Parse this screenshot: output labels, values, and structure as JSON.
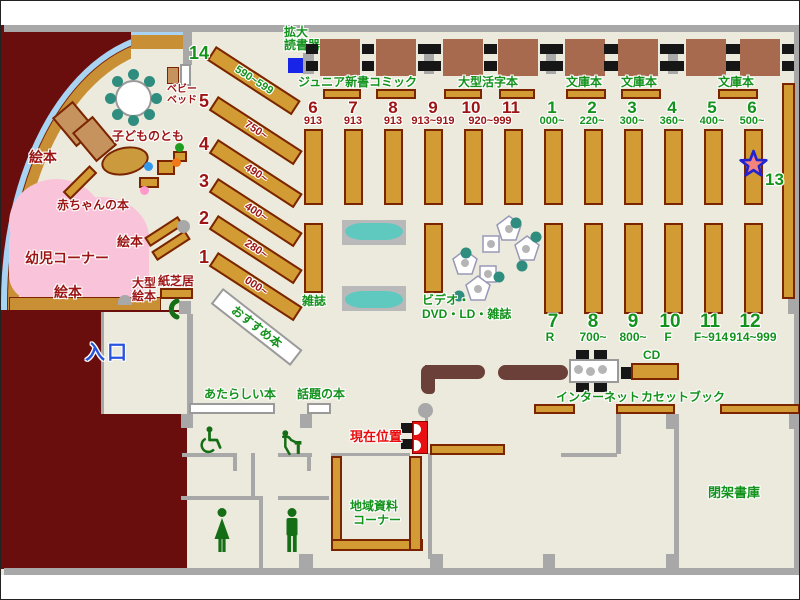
{
  "palette": {
    "floor": "#eceadc",
    "wall": "#a8a8a8",
    "shelf": "#d29b33",
    "entrance_block": "#6a0d0d",
    "counter": "#6a4038",
    "green": "#13921c",
    "dark_red": "#9c1414",
    "red": "#e80c0c",
    "blue": "#2953de",
    "pink": "#f9c3d9",
    "teal": "#2e8d7e",
    "sofa": "#5fc9bf",
    "glass": "#a8d3f2"
  },
  "entrance": {
    "label": "入口"
  },
  "kids_area": {
    "picture_books": "絵本",
    "infant_corner": "幼児コーナー",
    "baby_books": "赤ちゃんの本",
    "kodomono_tomo": "子どものとも",
    "baby_bed_line1": "ベビー",
    "baby_bed_line2": "ベッド",
    "large_picture_books_line1": "大型",
    "large_picture_books_line2": "絵本",
    "kamishibai": "紙芝居"
  },
  "west_shelves": [
    {
      "num": "14",
      "range": "590~599"
    },
    {
      "num": "5",
      "range": "750~"
    },
    {
      "num": "4",
      "range": "490~"
    },
    {
      "num": "3",
      "range": "400~"
    },
    {
      "num": "2",
      "range": "280~"
    },
    {
      "num": "1",
      "range": "000~"
    }
  ],
  "recommended_books": "おすすめ本",
  "magnifier": {
    "line1": "拡大",
    "line2": "読書器"
  },
  "sections": {
    "junior": "ジュニア新書",
    "comic": "コミック",
    "large_print": "大型活字本",
    "bunko1": "文庫本",
    "bunko2": "文庫本",
    "bunko3": "文庫本"
  },
  "north_columns": [
    {
      "num": "6",
      "range": "913"
    },
    {
      "num": "7",
      "range": "913"
    },
    {
      "num": "8",
      "range": "913"
    },
    {
      "num": "9",
      "range": "913~919"
    },
    {
      "num": "10",
      "range": "920~999"
    },
    {
      "num": "11",
      "range": ""
    }
  ],
  "east_columns": [
    {
      "num": "1",
      "range": "000~"
    },
    {
      "num": "2",
      "range": "220~"
    },
    {
      "num": "3",
      "range": "300~"
    },
    {
      "num": "4",
      "range": "360~"
    },
    {
      "num": "5",
      "range": "400~"
    },
    {
      "num": "6",
      "range": "500~"
    }
  ],
  "south_columns": [
    {
      "num": "7",
      "range": "R"
    },
    {
      "num": "8",
      "range": "700~"
    },
    {
      "num": "9",
      "range": "800~"
    },
    {
      "num": "10",
      "range": "F"
    },
    {
      "num": "11",
      "range": "F~914"
    },
    {
      "num": "12",
      "range": "914~999"
    }
  ],
  "shelf_13": "13",
  "center": {
    "magazines": "雑誌",
    "video_line1": "ビデオ・",
    "video_line2": "DVD・LD・雑誌"
  },
  "services": {
    "cd": "CD",
    "internet": "インターネット",
    "cassette_books": "カセットブック",
    "current_location": "現在位置",
    "closed_stacks": "閉架書庫",
    "local_line1": "地域資料",
    "local_line2": "コーナー",
    "new_books": "あたらしい本",
    "topical_books": "話題の本"
  }
}
